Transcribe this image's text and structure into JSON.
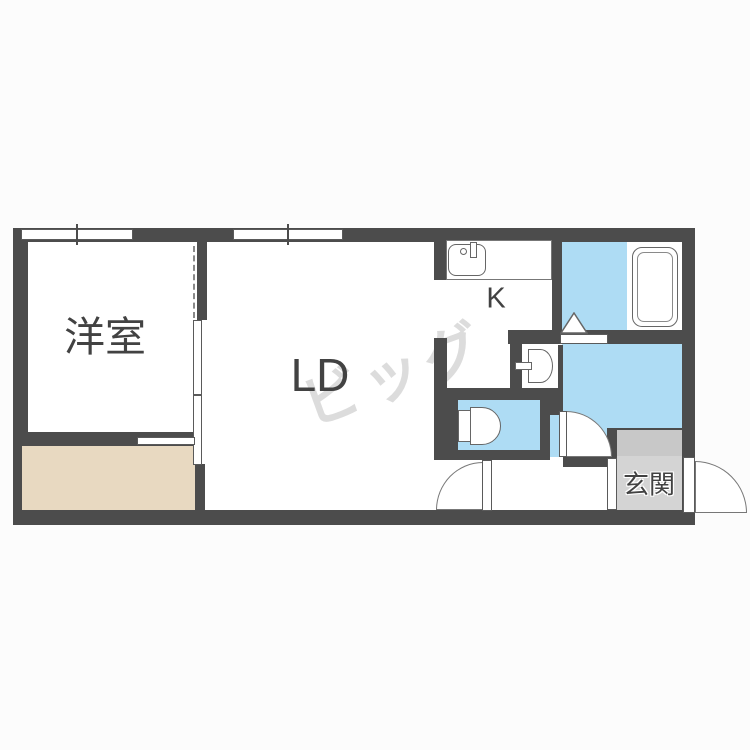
{
  "floorplan": {
    "labels": {
      "western_room": "洋室",
      "living_dining": "LD",
      "kitchen": "K",
      "entrance": "玄関"
    },
    "watermark_text": "ビッグ",
    "colors": {
      "wall": "#4c4c4c",
      "water_area_blue": "#aedcf4",
      "closet_floor_tan": "#e8d9c1",
      "entrance_step_gray": "#c8c8c8",
      "entrance_floor_gray": "#d4d4d4",
      "fixture_line": "#666666",
      "page_background": "#fcfcfc"
    },
    "icons": [
      "kitchen-sink-icon",
      "bathtub-icon",
      "washbasin-icon",
      "toilet-icon",
      "bathroom-door-triangle-icon",
      "door-swing-arc",
      "window",
      "sliding-door"
    ]
  }
}
